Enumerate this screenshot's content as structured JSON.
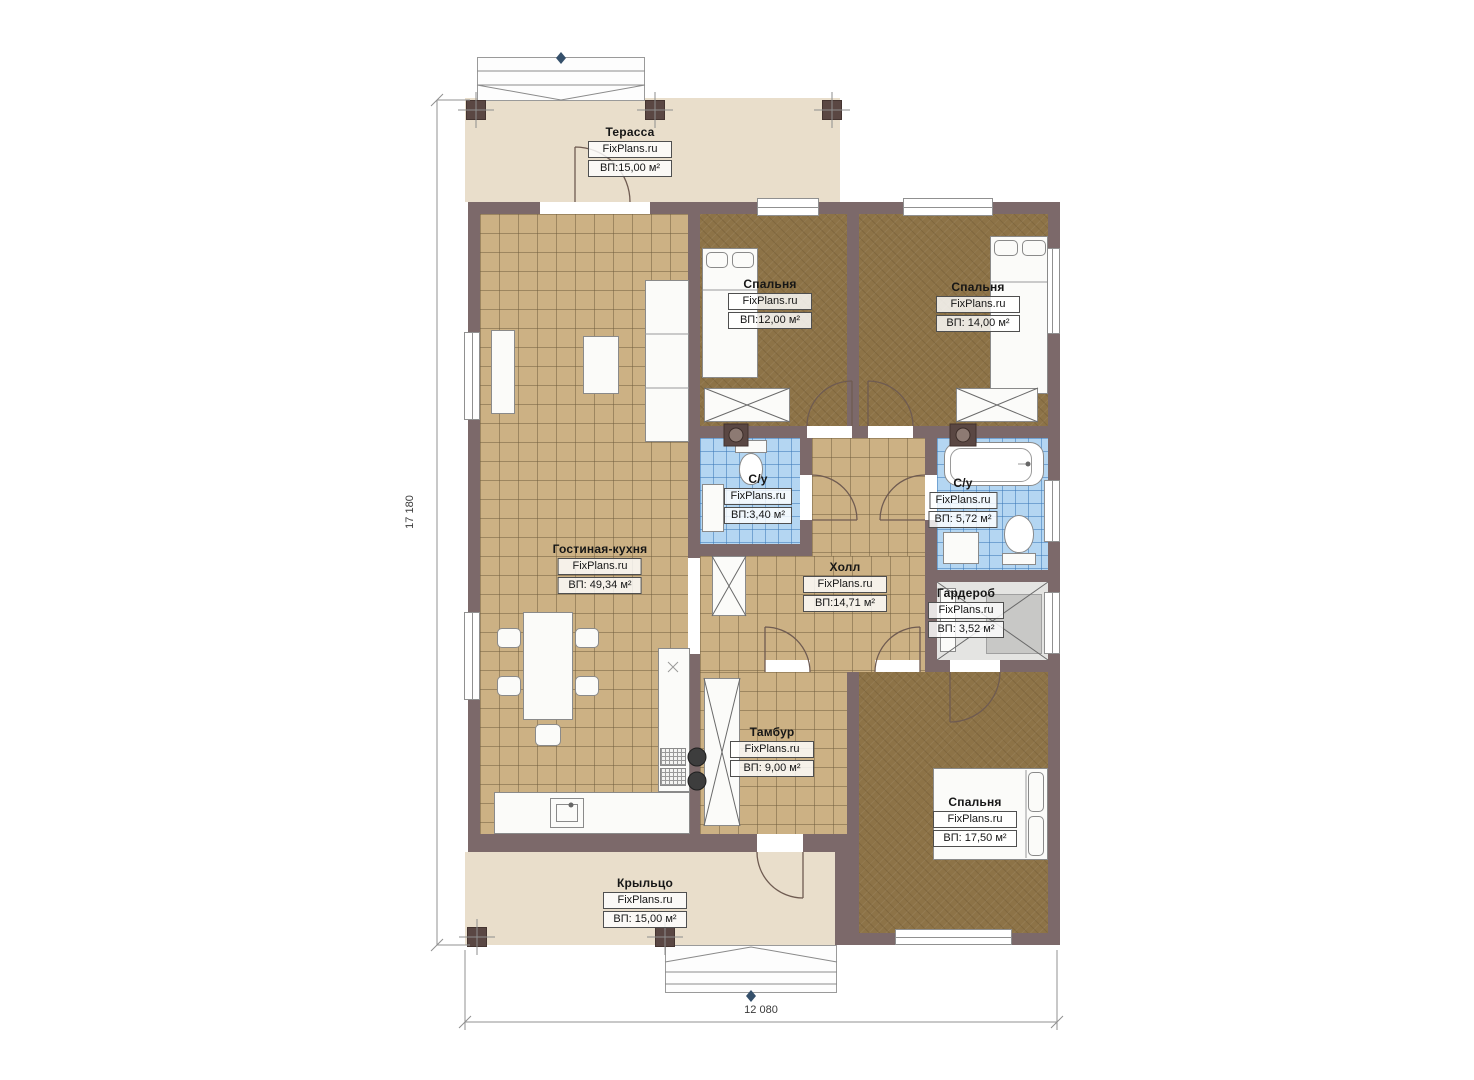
{
  "watermark": "FixPlans.ru",
  "dimensions": {
    "height_label": "17 180",
    "width_label": "12 080"
  },
  "rooms": [
    {
      "id": "terrace",
      "name": "Терасса",
      "area": "ВП:15,00 м²"
    },
    {
      "id": "bedroom-1",
      "name": "Спальня",
      "area": "ВП:12,00 м²"
    },
    {
      "id": "bedroom-2",
      "name": "Спальня",
      "area": "ВП: 14,00 м²"
    },
    {
      "id": "bathroom-1",
      "name": "С/у",
      "area": "ВП:3,40 м²"
    },
    {
      "id": "bathroom-2",
      "name": "С/у",
      "area": "ВП: 5,72 м²"
    },
    {
      "id": "living-kitchen",
      "name": "Гостиная-кухня",
      "area": "ВП: 49,34 м²"
    },
    {
      "id": "hall",
      "name": "Холл",
      "area": "ВП:14,71 м²"
    },
    {
      "id": "wardrobe",
      "name": "Гардероб",
      "area": "ВП: 3,52 м²"
    },
    {
      "id": "vestibule",
      "name": "Тамбур",
      "area": "ВП: 9,00 м²"
    },
    {
      "id": "bedroom-3",
      "name": "Спальня",
      "area": "ВП: 17,50 м²"
    },
    {
      "id": "porch",
      "name": "Крыльцо",
      "area": "ВП: 15,00 м²"
    }
  ],
  "colors": {
    "wall": "#7c696a",
    "post": "#5a4743",
    "terrace_floor": "#e9decb",
    "tile_floor": "#ccb184",
    "bathroom_floor": "#b4d6f2",
    "bedroom_floor": "#8d7347",
    "wardrobe_floor": "#e4e4e2"
  }
}
